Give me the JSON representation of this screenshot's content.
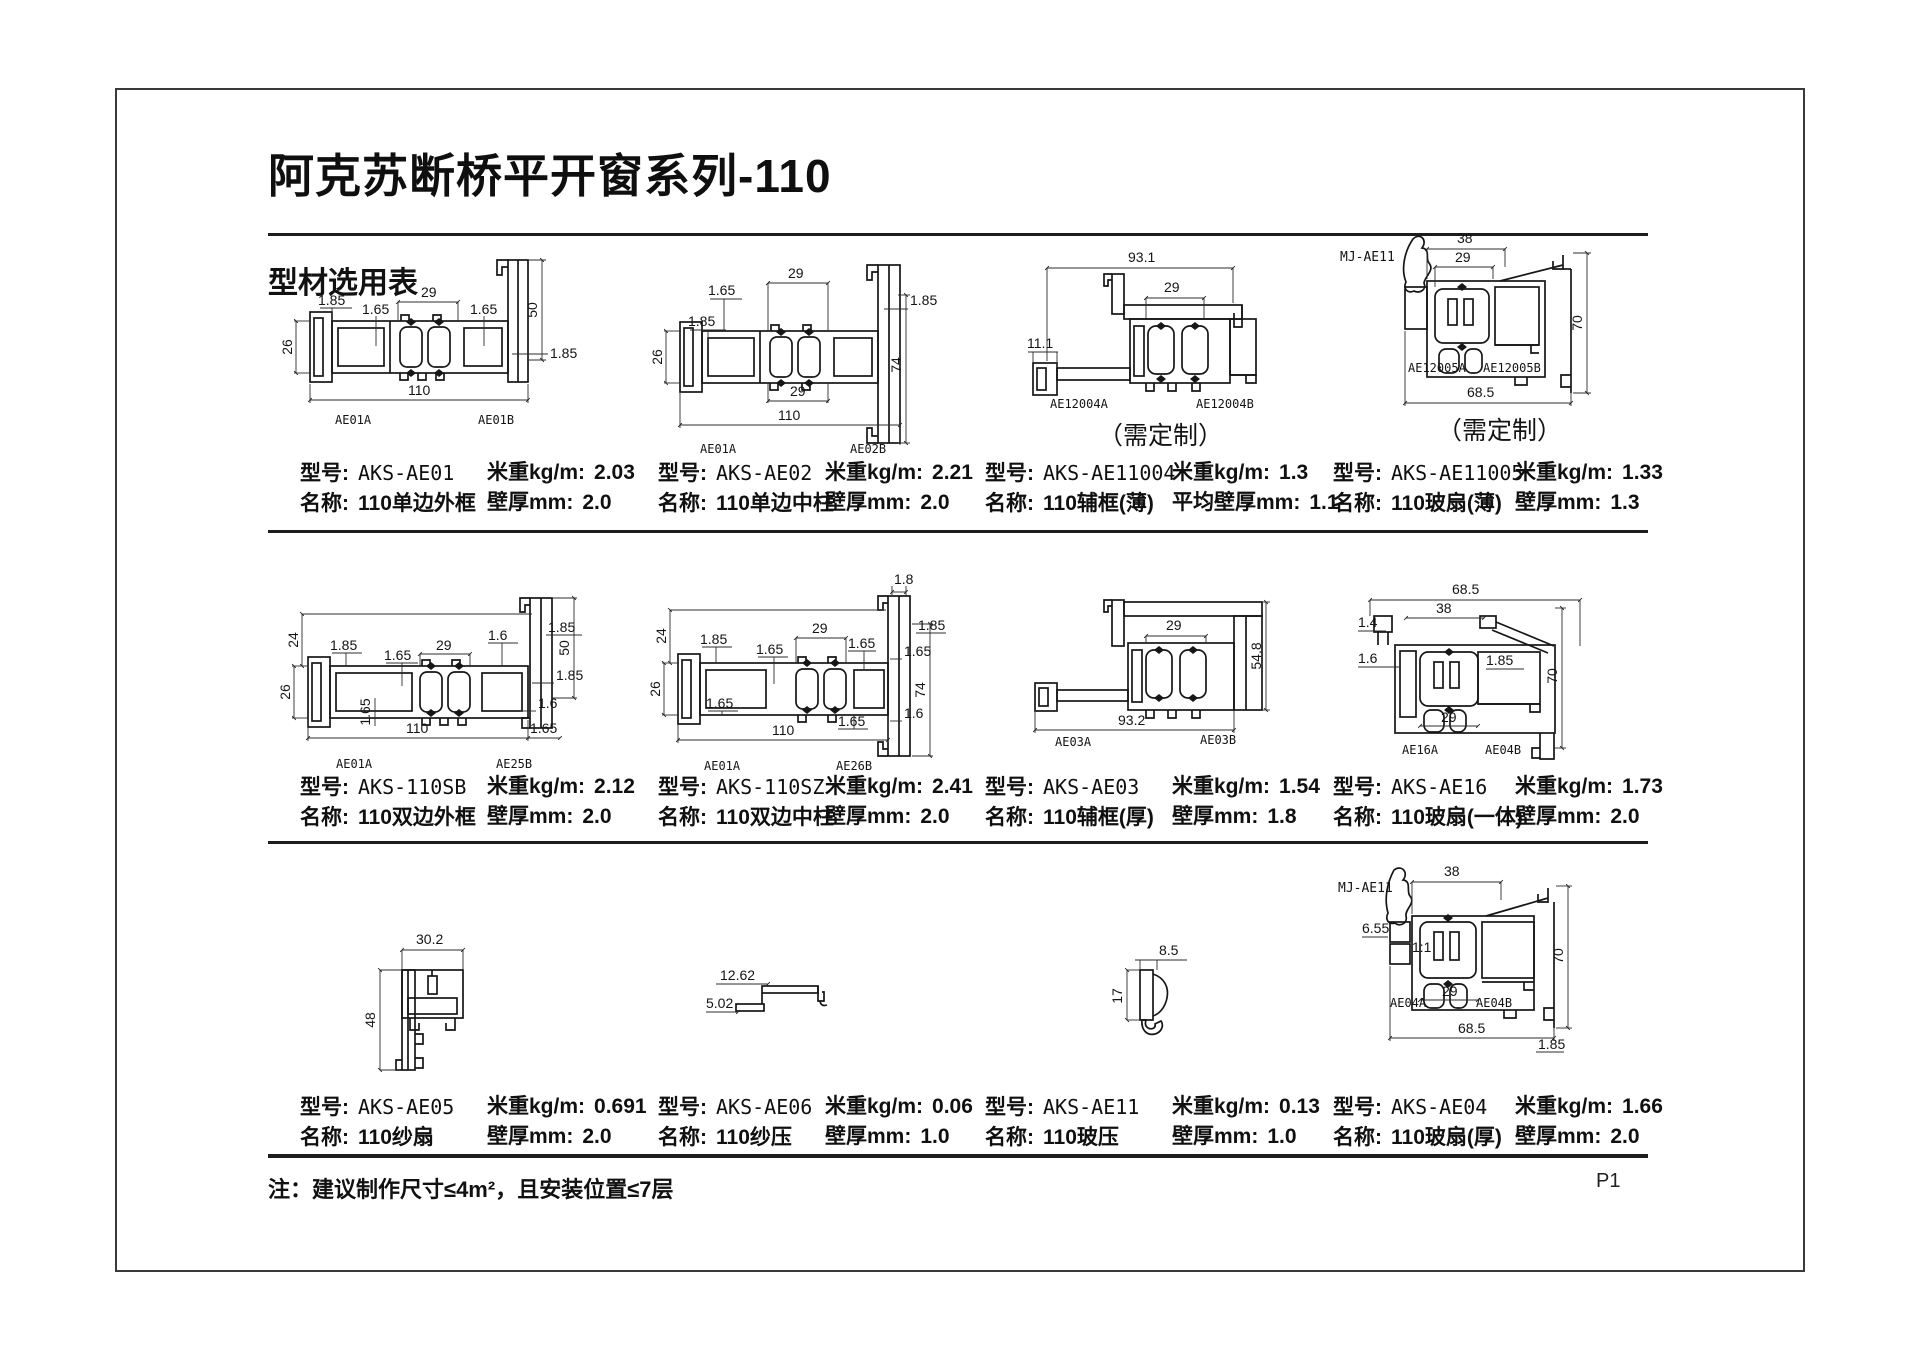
{
  "page": {
    "title": "阿克苏断桥平开窗系列-110",
    "subtitle": "型材选用表",
    "note": "注：建议制作尺寸≤4m²，且安装位置≤7层",
    "page_number": "P1"
  },
  "labels": {
    "model": "型号:",
    "name": "名称:",
    "weight": "米重kg/m:"
  },
  "cells": [
    {
      "model": "AKS-AE01",
      "name": "110单边外框",
      "weight": "2.03",
      "thickness_label": "壁厚mm:",
      "thickness": "2.0",
      "parts": [
        "AE01A",
        "AE01B"
      ],
      "dims": [
        "1.85",
        "1.65",
        "29",
        "1.65",
        "50",
        "1.85",
        "26",
        "110"
      ]
    },
    {
      "model": "AKS-AE02",
      "name": "110单边中柱",
      "weight": "2.21",
      "thickness_label": "壁厚mm:",
      "thickness": "2.0",
      "parts": [
        "AE01A",
        "AE02B"
      ],
      "dims": [
        "1.65",
        "29",
        "1.85",
        "1.85",
        "26",
        "29",
        "74",
        "110"
      ]
    },
    {
      "model": "AKS-AE11004",
      "name": "110辅框(薄)",
      "weight": "1.3",
      "thickness_label": "平均壁厚mm:",
      "thickness": "1.1",
      "parts": [
        "AE12004A",
        "AE12004B"
      ],
      "caption": "（需定制）",
      "dims": [
        "93.1",
        "29",
        "11.1"
      ]
    },
    {
      "model": "AKS-AE11005",
      "name": "110玻扇(薄)",
      "weight": "1.33",
      "thickness_label": "壁厚mm:",
      "thickness": "1.3",
      "parts": [
        "AE12005A",
        "AE12005B"
      ],
      "caption": "（需定制）",
      "corner": "MJ-AE11",
      "dims": [
        "38",
        "29",
        "70",
        "68.5"
      ]
    },
    {
      "model": "AKS-110SB",
      "name": "110双边外框",
      "weight": "2.12",
      "thickness_label": "壁厚mm:",
      "thickness": "2.0",
      "parts": [
        "AE01A",
        "AE25B"
      ],
      "dims": [
        "24",
        "1.85",
        "1.65",
        "29",
        "1.6",
        "1.85",
        "50",
        "1.85",
        "1.6",
        "26",
        "1.65",
        "110",
        "1.65"
      ]
    },
    {
      "model": "AKS-110SZ",
      "name": "110双边中柱",
      "weight": "2.41",
      "thickness_label": "壁厚mm:",
      "thickness": "2.0",
      "parts": [
        "AE01A",
        "AE26B"
      ],
      "dims": [
        "1.8",
        "24",
        "1.85",
        "1.65",
        "29",
        "1.65",
        "1.85",
        "1.65",
        "26",
        "1.65",
        "74",
        "1.65",
        "1.6",
        "110"
      ]
    },
    {
      "model": "AKS-AE03",
      "name": "110辅框(厚)",
      "weight": "1.54",
      "thickness_label": "壁厚mm:",
      "thickness": "1.8",
      "parts": [
        "AE03A",
        "AE03B"
      ],
      "dims": [
        "29",
        "54.8",
        "93.2"
      ]
    },
    {
      "model": "AKS-AE16",
      "name": "110玻扇(一体)",
      "weight": "1.73",
      "thickness_label": "壁厚mm:",
      "thickness": "2.0",
      "parts": [
        "AE16A",
        "AE04B"
      ],
      "dims": [
        "68.5",
        "38",
        "1.4",
        "1.6",
        "1.85",
        "70",
        "29"
      ]
    },
    {
      "model": "AKS-AE05",
      "name": "110纱扇",
      "weight": "0.691",
      "thickness_label": "壁厚mm:",
      "thickness": "2.0",
      "parts": [],
      "dims": [
        "30.2",
        "48"
      ]
    },
    {
      "model": "AKS-AE06",
      "name": "110纱压",
      "weight": "0.06",
      "thickness_label": "壁厚mm:",
      "thickness": "1.0",
      "parts": [],
      "dims": [
        "12.62",
        "5.02"
      ]
    },
    {
      "model": "AKS-AE11",
      "name": "110玻压",
      "weight": "0.13",
      "thickness_label": "壁厚mm:",
      "thickness": "1.0",
      "parts": [],
      "dims": [
        "8.5",
        "17"
      ]
    },
    {
      "model": "AKS-AE04",
      "name": "110玻扇(厚)",
      "weight": "1.66",
      "thickness_label": "壁厚mm:",
      "thickness": "2.0",
      "parts": [
        "AE04A",
        "AE04B"
      ],
      "corner": "MJ-AE11",
      "dims": [
        "38",
        "6.55",
        "1:1",
        "29",
        "70",
        "68.5",
        "1.85"
      ]
    }
  ]
}
